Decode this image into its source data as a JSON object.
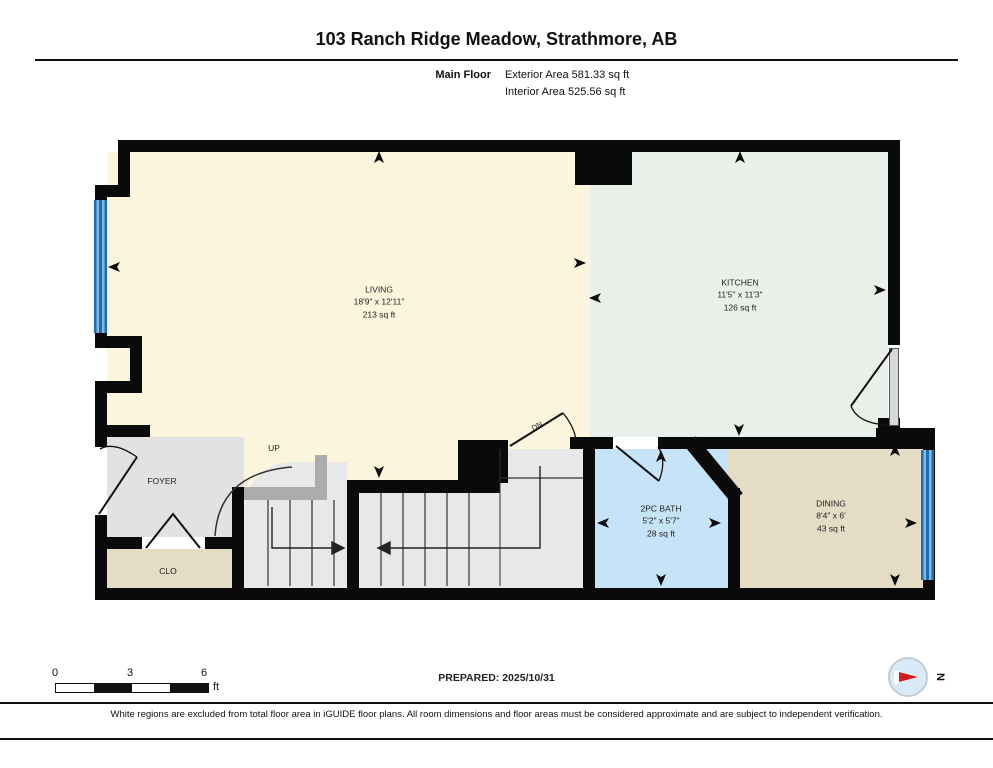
{
  "header": {
    "title": "103 Ranch Ridge Meadow, Strathmore, AB",
    "floor_label": "Main Floor",
    "exterior_area": "Exterior Area 581.33 sq ft",
    "interior_area": "Interior Area 525.56 sq ft"
  },
  "plan": {
    "rooms": {
      "living": {
        "name": "LIVING",
        "dims": "18'9\" x 12'11\"",
        "area": "213 sq ft"
      },
      "kitchen": {
        "name": "KITCHEN",
        "dims": "11'5\" x 11'3\"",
        "area": "126 sq ft"
      },
      "bath": {
        "name": "2PC BATH",
        "dims": "5'2\" x 5'7\"",
        "area": "28 sq ft"
      },
      "dining": {
        "name": "DINING",
        "dims": "8'4\" x 6'",
        "area": "43 sq ft"
      },
      "foyer": {
        "name": "FOYER"
      },
      "closet": {
        "name": "CLO"
      }
    },
    "labels": {
      "up": "UP",
      "down": "DN"
    }
  },
  "scale_bar": {
    "start": "0",
    "mid": "3",
    "end": "6",
    "unit": "ft"
  },
  "footer": {
    "prepared": "PREPARED: 2025/10/31",
    "compass": "N",
    "disclaimer": "White regions are excluded from total floor area in iGUIDE floor plans. All room dimensions and floor areas must be considered approximate and are subject to independent verification."
  },
  "colors": {
    "living": "#fbf5de",
    "kitchen": "#e9f0ea",
    "dining": "#e5dcc5",
    "bath": "#c7e3f8",
    "foyer": "#e2e2e2",
    "stairs": "#e8e8e8",
    "wall": "#0a0a0a",
    "window_blue": "#5aa7dc",
    "compass_red": "#cf1d1d"
  }
}
